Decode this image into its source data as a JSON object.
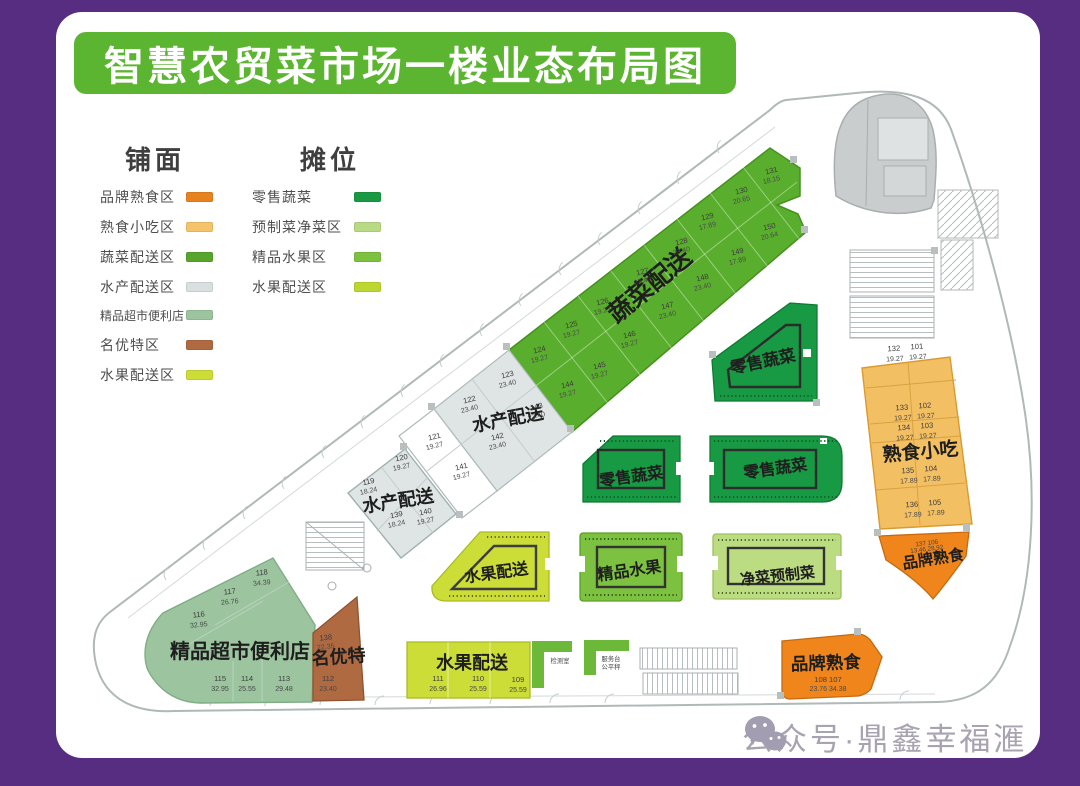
{
  "window": {
    "title": "智慧农贸菜市场一楼业态布局图",
    "watermark": "公众号·鼎鑫幸福滙"
  },
  "colors": {
    "frame_purple": "#572d82",
    "title_green": "#5cb531",
    "brand_deli_orange": "#f0861b",
    "snack_orange": "#f3bf63",
    "veg_delivery_green": "#5aae2e",
    "aqua_delivery_gray": "#dfe5e4",
    "supermarket_sage": "#9bc49f",
    "specialty_brown": "#b06a42",
    "fruit_delivery_yellow": "#ccdd37",
    "retail_veg_green": "#179a43",
    "prepared_veg_light": "#bcdc82",
    "premium_fruit_green": "#7cc13f"
  },
  "legend": {
    "shopfront": {
      "title": "铺面",
      "items": [
        {
          "label": "品牌熟食区",
          "color": "#e8821e"
        },
        {
          "label": "熟食小吃区",
          "color": "#f6c468"
        },
        {
          "label": "蔬菜配送区",
          "color": "#57a52c"
        },
        {
          "label": "水产配送区",
          "color": "#d9e0df"
        },
        {
          "label": "精品超市便利店",
          "color": "#9bc49f"
        },
        {
          "label": "名优特区",
          "color": "#b06a42"
        },
        {
          "label": "水果配送区",
          "color": "#ccdd37"
        }
      ]
    },
    "stall": {
      "title": "摊位",
      "items": [
        {
          "label": "零售蔬菜",
          "color": "#179a43"
        },
        {
          "label": "预制菜净菜区",
          "color": "#b8da84"
        },
        {
          "label": "精品水果区",
          "color": "#7cc13f"
        },
        {
          "label": "水果配送区",
          "color": "#bdd631"
        }
      ]
    }
  },
  "plan": {
    "veg_band": {
      "label": "蔬菜配送",
      "units": [
        {
          "id": "124",
          "area": "19.27"
        },
        {
          "id": "125",
          "area": "19.27"
        },
        {
          "id": "126",
          "area": "19.27"
        },
        {
          "id": "127",
          "area": "23.40"
        },
        {
          "id": "128",
          "area": "23.40"
        },
        {
          "id": "129",
          "area": "17.89"
        },
        {
          "id": "130",
          "area": "20.65"
        },
        {
          "id": "131",
          "area": "18.15"
        },
        {
          "id": "144",
          "area": "19.27"
        },
        {
          "id": "145",
          "area": "19.27"
        },
        {
          "id": "146",
          "area": "19.27"
        },
        {
          "id": "147",
          "area": "23.40"
        },
        {
          "id": "148",
          "area": "23.40"
        },
        {
          "id": "149",
          "area": "17.89"
        },
        {
          "id": "150",
          "area": "20.64"
        }
      ]
    },
    "aqua_upper": {
      "label": "水产配送",
      "units": [
        {
          "id": "123",
          "area": "23.40"
        },
        {
          "id": "143",
          "area": "23.40"
        },
        {
          "id": "122",
          "area": "23.40"
        },
        {
          "id": "142",
          "area": "23.40"
        }
      ]
    },
    "corridor_units": [
      {
        "id": "121",
        "area": "19.27"
      },
      {
        "id": "141",
        "area": "19.27"
      }
    ],
    "aqua_lower": {
      "label": "水产配送",
      "units": [
        {
          "id": "120",
          "area": "19.27"
        },
        {
          "id": "119",
          "area": "18.24"
        },
        {
          "id": "139",
          "area": "18.24"
        },
        {
          "id": "140",
          "area": "19.27"
        }
      ]
    },
    "supermarket": {
      "label": "精品超市便利店",
      "units": [
        {
          "id": "118",
          "area": "34.39"
        },
        {
          "id": "117",
          "area": "26.76"
        },
        {
          "id": "116",
          "area": "32.95"
        },
        {
          "id": "115",
          "area": "32.95"
        },
        {
          "id": "114",
          "area": "25.55"
        },
        {
          "id": "113",
          "area": "29.48"
        }
      ]
    },
    "specialty": {
      "label": "名优特",
      "units": [
        {
          "id": "138",
          "area": "22.35"
        },
        {
          "id": "112",
          "area": "23.40"
        }
      ]
    },
    "fruit_shop": {
      "label": "水果配送",
      "units": [
        {
          "id": "111",
          "area": "26.96"
        },
        {
          "id": "110",
          "area": "25.59"
        },
        {
          "id": "109",
          "area": "25.59"
        }
      ]
    },
    "snack_band": {
      "label": "熟食小吃",
      "rows": [
        {
          "l_id": "132",
          "r_id": "101",
          "l_area": "19.27",
          "r_area": "19.27"
        },
        {
          "l_id": "133",
          "r_id": "102",
          "l_area": "19.27",
          "r_area": "19.27"
        },
        {
          "l_id": "134",
          "r_id": "103",
          "l_area": "19.27",
          "r_area": "19.27"
        },
        {
          "l_id": "135",
          "r_id": "104",
          "l_area": "17.89",
          "r_area": "17.89"
        },
        {
          "l_id": "136",
          "r_id": "105",
          "l_area": "17.89",
          "r_area": "17.89"
        }
      ]
    },
    "brand_deli_top": {
      "label": "品牌熟食",
      "ids": "137 106",
      "areas": "13.46 28.92"
    },
    "brand_deli_bottom": {
      "label": "品牌熟食",
      "ids": "108 107",
      "areas": "23.76 34.38"
    },
    "islands": {
      "retail_veg": "零售蔬菜",
      "fruit_delivery": "水果配送",
      "premium_fruit": "精品水果",
      "clean_prepared": "净菜预制菜"
    },
    "facilities": {
      "test_room": "检测室",
      "service_desk": "服务台",
      "fair_scale": "公平秤"
    }
  }
}
